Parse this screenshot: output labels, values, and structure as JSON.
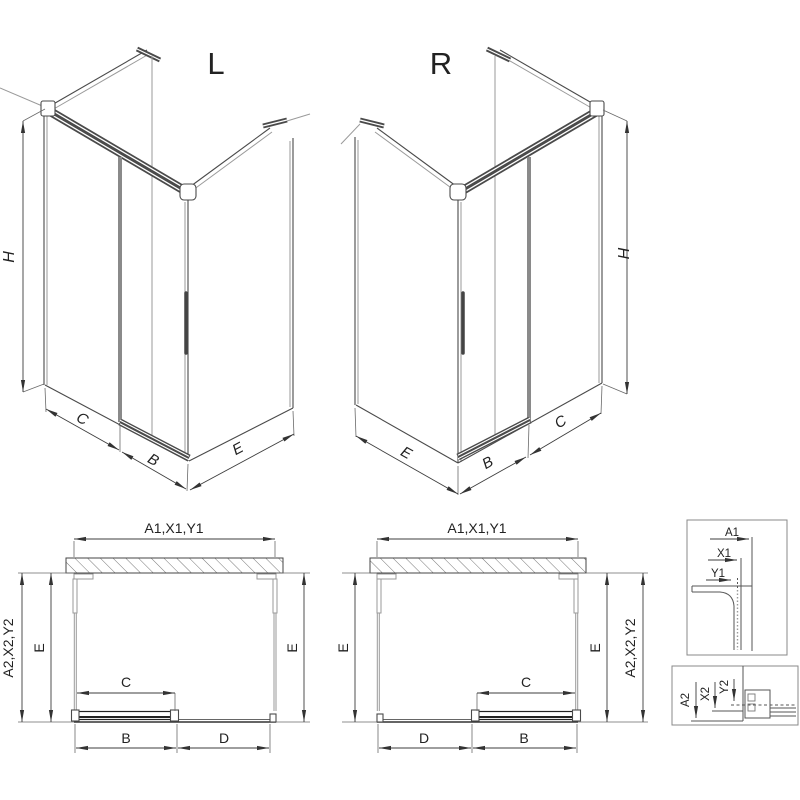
{
  "drawing": {
    "background": "#ffffff",
    "line_color": "#4a4a4a",
    "dim_color": "#3c3c3c",
    "glass_color": "#9a9a9a",
    "door_color": "#8a8a8a"
  },
  "iso_left": {
    "title": "L",
    "dims": {
      "h": "H",
      "c": "C",
      "b": "B",
      "e": "E"
    }
  },
  "iso_right": {
    "title": "R",
    "dims": {
      "h": "H",
      "e": "E",
      "b": "B",
      "c": "C"
    }
  },
  "plan_left": {
    "dims": {
      "top": "A1,X1,Y1",
      "left_outer": "A2,X2,Y2",
      "left_inner": "E",
      "right": "E",
      "c": "C",
      "b": "B",
      "d": "D"
    }
  },
  "plan_right": {
    "dims": {
      "top": "A1,X1,Y1",
      "left": "E",
      "right_inner": "E",
      "right_outer": "A2,X2,Y2",
      "c": "C",
      "d": "D",
      "b": "B"
    }
  },
  "detail_top": {
    "a1": "A1",
    "x1": "X1",
    "y1": "Y1"
  },
  "detail_bottom": {
    "a2": "A2",
    "x2": "X2",
    "y2": "Y2"
  }
}
